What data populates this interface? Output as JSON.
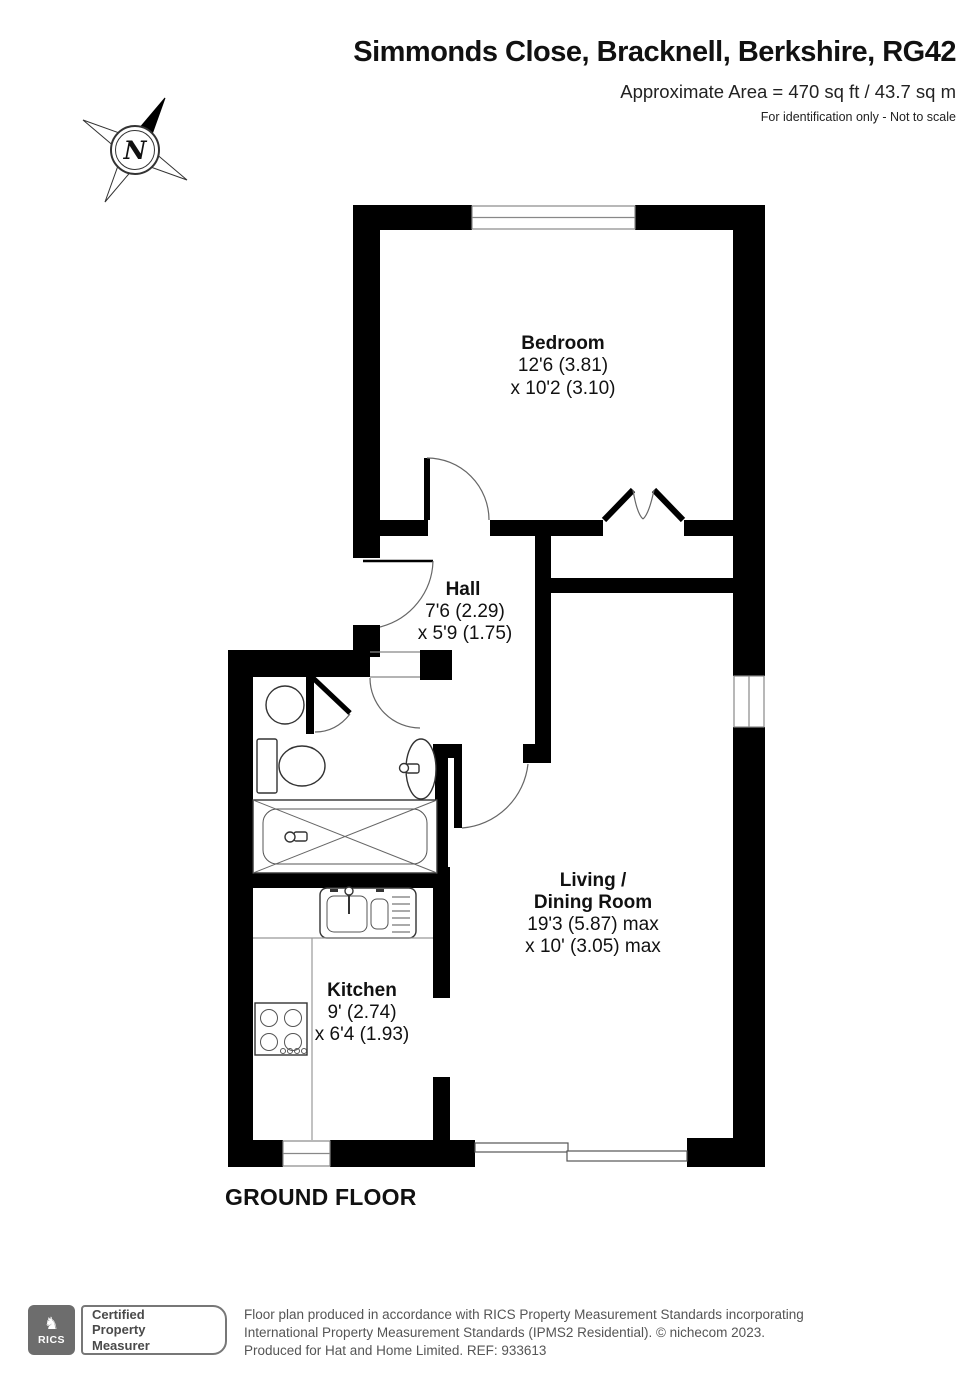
{
  "header": {
    "title": "Simmonds Close, Bracknell, Berkshire, RG42",
    "area_line": "Approximate Area = 470 sq ft / 43.7 sq m",
    "disclaimer": "For identification only - Not to scale"
  },
  "compass": {
    "label": "N"
  },
  "floor": {
    "label": "GROUND FLOOR"
  },
  "rooms": {
    "bedroom": {
      "name": "Bedroom",
      "dim1": "12'6 (3.81)",
      "dim2": "x 10'2 (3.10)"
    },
    "hall": {
      "name": "Hall",
      "dim1": "7'6 (2.29)",
      "dim2": "x 5'9 (1.75)"
    },
    "living": {
      "name1": "Living /",
      "name2": "Dining Room",
      "dim1": "19'3 (5.87) max",
      "dim2": "x 10' (3.05) max"
    },
    "kitchen": {
      "name": "Kitchen",
      "dim1": "9' (2.74)",
      "dim2": "x 6'4 (1.93)"
    }
  },
  "footer": {
    "rics_label": "RICS",
    "badge_line1": "Certified",
    "badge_line2": "Property",
    "badge_line3": "Measurer",
    "line1": "Floor plan produced in accordance with RICS Property Measurement Standards incorporating",
    "line2": "International Property Measurement Standards (IPMS2 Residential).  © nichecom 2023.",
    "line3": "Produced for Hat and Home Limited.  REF: 933613"
  },
  "colors": {
    "wall": "#000000",
    "window_line": "#888888",
    "footer_gray": "#555555",
    "logo_gray": "#6d6d6d"
  }
}
